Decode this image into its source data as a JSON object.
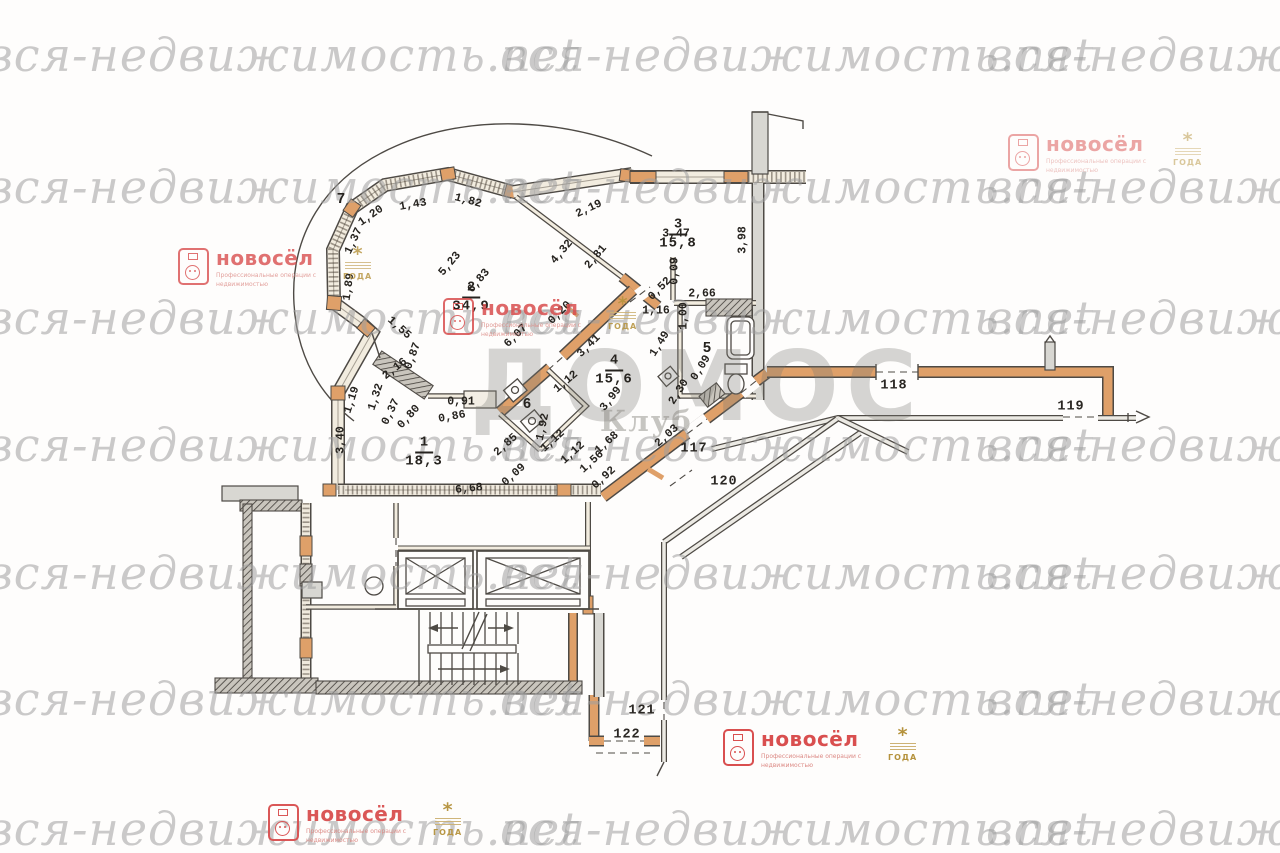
{
  "watermark": {
    "text": "вся-недвижимость.net",
    "color": "#9e9e9e",
    "row_tops": [
      28,
      160,
      291,
      418,
      546,
      672,
      802
    ],
    "col_lefts": [
      -14,
      500,
      986
    ]
  },
  "domos_watermark": {
    "title": "ДОМОС",
    "subtitle": "Клуб"
  },
  "brand": {
    "name": "новосёл",
    "subtitle_line1": "Профессиональные операции",
    "subtitle_line2": "с недвижимостью",
    "award_star": "*",
    "award_text": "ГОДА",
    "red": "#d94f4f",
    "gold": "#b5923c",
    "instances": [
      {
        "x": 178,
        "y": 248,
        "opacity": 0.8
      },
      {
        "x": 1008,
        "y": 134,
        "opacity": 0.5
      },
      {
        "x": 443,
        "y": 298,
        "opacity": 0.85
      },
      {
        "x": 723,
        "y": 729,
        "opacity": 1
      },
      {
        "x": 268,
        "y": 804,
        "opacity": 0.95
      }
    ]
  },
  "plan_colors": {
    "wall_orange": "#dfa069",
    "wall_gray": "#d8d7d2",
    "line": "#4e4a45",
    "paper": "#fefdfc"
  },
  "rooms": [
    {
      "num": "7",
      "area": "",
      "x": 341,
      "y": 199
    },
    {
      "num": "2",
      "area": "34,9",
      "x": 471,
      "y": 296
    },
    {
      "num": "3",
      "area": "15,8",
      "x": 678,
      "y": 233
    },
    {
      "num": "4",
      "area": "15,6",
      "x": 614,
      "y": 369
    },
    {
      "num": "5",
      "area": "",
      "x": 707,
      "y": 348
    },
    {
      "num": "6",
      "area": "",
      "x": 527,
      "y": 404
    },
    {
      "num": "1",
      "area": "18,3",
      "x": 424,
      "y": 451
    }
  ],
  "corridors": [
    {
      "label": "117",
      "x": 694,
      "y": 449
    },
    {
      "label": "118",
      "x": 894,
      "y": 386
    },
    {
      "label": "119",
      "x": 1071,
      "y": 407
    },
    {
      "label": "120",
      "x": 724,
      "y": 482
    },
    {
      "label": "121",
      "x": 642,
      "y": 711
    },
    {
      "label": "122",
      "x": 627,
      "y": 735
    }
  ],
  "dimensions": [
    {
      "t": "1,82",
      "x": 468,
      "y": 201,
      "r": 15
    },
    {
      "t": "1,43",
      "x": 413,
      "y": 205,
      "r": -10
    },
    {
      "t": "1,20",
      "x": 371,
      "y": 216,
      "r": -35
    },
    {
      "t": "1,37",
      "x": 354,
      "y": 241,
      "r": -65
    },
    {
      "t": "1,89",
      "x": 349,
      "y": 287,
      "r": -82
    },
    {
      "t": "1,55",
      "x": 399,
      "y": 328,
      "r": 42
    },
    {
      "t": "2,19",
      "x": 589,
      "y": 209,
      "r": -25
    },
    {
      "t": "3,47",
      "x": 676,
      "y": 234,
      "r": 0
    },
    {
      "t": "3,98",
      "x": 743,
      "y": 240,
      "r": -90
    },
    {
      "t": "4,32",
      "x": 562,
      "y": 252,
      "r": -50
    },
    {
      "t": "2,81",
      "x": 596,
      "y": 257,
      "r": -50
    },
    {
      "t": "5,23",
      "x": 450,
      "y": 264,
      "r": -50
    },
    {
      "t": "6,83",
      "x": 479,
      "y": 281,
      "r": -50
    },
    {
      "t": "0,20",
      "x": 560,
      "y": 313,
      "r": -45
    },
    {
      "t": "6,07",
      "x": 516,
      "y": 336,
      "r": -45
    },
    {
      "t": "0,09",
      "x": 675,
      "y": 271,
      "r": -90
    },
    {
      "t": "0,52",
      "x": 660,
      "y": 289,
      "r": -45
    },
    {
      "t": "2,66",
      "x": 702,
      "y": 294,
      "r": 0
    },
    {
      "t": "1,16",
      "x": 656,
      "y": 311,
      "r": 0
    },
    {
      "t": "1,00",
      "x": 684,
      "y": 316,
      "r": -90
    },
    {
      "t": "3,41",
      "x": 589,
      "y": 346,
      "r": -45
    },
    {
      "t": "1,49",
      "x": 660,
      "y": 344,
      "r": -58
    },
    {
      "t": "0,09",
      "x": 701,
      "y": 368,
      "r": -58
    },
    {
      "t": "2,30",
      "x": 679,
      "y": 392,
      "r": -58
    },
    {
      "t": "3,99",
      "x": 611,
      "y": 399,
      "r": -52
    },
    {
      "t": "2,16",
      "x": 395,
      "y": 369,
      "r": -38
    },
    {
      "t": "0,87",
      "x": 413,
      "y": 356,
      "r": -70
    },
    {
      "t": "1,19",
      "x": 352,
      "y": 400,
      "r": -72
    },
    {
      "t": "1,32",
      "x": 376,
      "y": 397,
      "r": -72
    },
    {
      "t": "0,37",
      "x": 391,
      "y": 412,
      "r": -64
    },
    {
      "t": "0,80",
      "x": 409,
      "y": 417,
      "r": -48
    },
    {
      "t": "0,86",
      "x": 452,
      "y": 417,
      "r": -10
    },
    {
      "t": "0,91",
      "x": 461,
      "y": 402,
      "r": 0
    },
    {
      "t": "1,92",
      "x": 543,
      "y": 427,
      "r": -78
    },
    {
      "t": "1,12",
      "x": 566,
      "y": 382,
      "r": -40
    },
    {
      "t": "2,85",
      "x": 506,
      "y": 445,
      "r": -42
    },
    {
      "t": "0,09",
      "x": 514,
      "y": 475,
      "r": -42
    },
    {
      "t": "6,68",
      "x": 469,
      "y": 489,
      "r": -6
    },
    {
      "t": "1,12",
      "x": 553,
      "y": 441,
      "r": -42
    },
    {
      "t": "1,12",
      "x": 573,
      "y": 453,
      "r": -42
    },
    {
      "t": "1,56",
      "x": 592,
      "y": 462,
      "r": -42
    },
    {
      "t": "0,92",
      "x": 604,
      "y": 478,
      "r": -42
    },
    {
      "t": "1,68",
      "x": 607,
      "y": 443,
      "r": -42
    },
    {
      "t": "2,03",
      "x": 667,
      "y": 436,
      "r": -42
    },
    {
      "t": "3,40",
      "x": 341,
      "y": 440,
      "r": -90
    }
  ]
}
